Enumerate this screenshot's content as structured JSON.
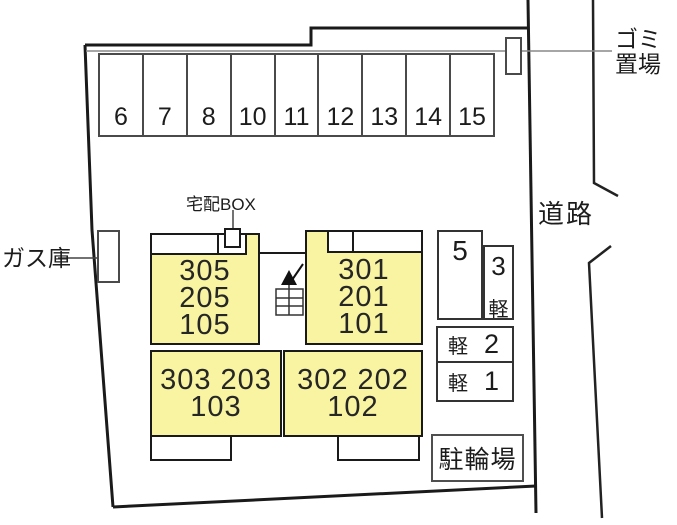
{
  "labels": {
    "garbage_line1": "ゴミ",
    "garbage_line2": "置場",
    "road": "道路",
    "gas": "ガス庫",
    "delivery_box": "宅配BOX",
    "bicycle_parking": "駐輪場"
  },
  "parking_row": {
    "stalls": [
      "6",
      "7",
      "8",
      "10",
      "11",
      "12",
      "13",
      "14",
      "15"
    ]
  },
  "side_parking": {
    "stall_5": "5",
    "stall_3": {
      "number": "3",
      "type": "軽"
    },
    "stall_2": {
      "number": "2",
      "type": "軽"
    },
    "stall_1": {
      "number": "1",
      "type": "軽"
    }
  },
  "building": {
    "upper_left_rooms": [
      "305",
      "205",
      "105"
    ],
    "upper_right_rooms": [
      "301",
      "201",
      "101"
    ],
    "lower_left_rooms": [
      "303 203",
      "103"
    ],
    "lower_right_rooms": [
      "302 202",
      "102"
    ]
  },
  "colors": {
    "room_fill": "#F8F4A1",
    "outline": "#1A1A1A",
    "thin_line": "#888888"
  }
}
